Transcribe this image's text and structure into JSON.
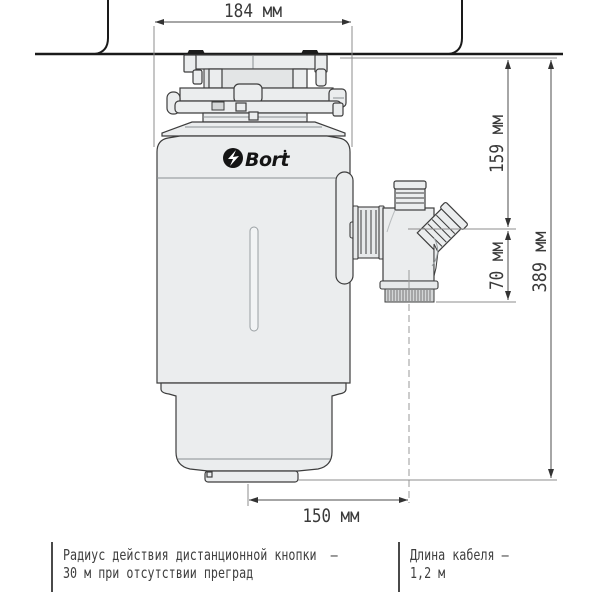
{
  "brand": "Bort",
  "dimensions": {
    "top_width": "184 мм",
    "upper_height": "159 мм",
    "outlet_offset": "70 мм",
    "total_height": "389 мм",
    "base_width": "150 мм"
  },
  "footnotes": {
    "remote_line1": "Радиус действия дистанционной кнопки  –",
    "remote_line2": "30 м при отсутствии преград",
    "cable_line1": "Длина кабеля –",
    "cable_line2": "1,2 м"
  },
  "colors": {
    "outline": "#3d3d3d",
    "body_fill": "#ebedee",
    "counter_line": "#1a1a1a",
    "dimension": "#4d4d4d",
    "footnote_text": "#3f3f3f"
  }
}
